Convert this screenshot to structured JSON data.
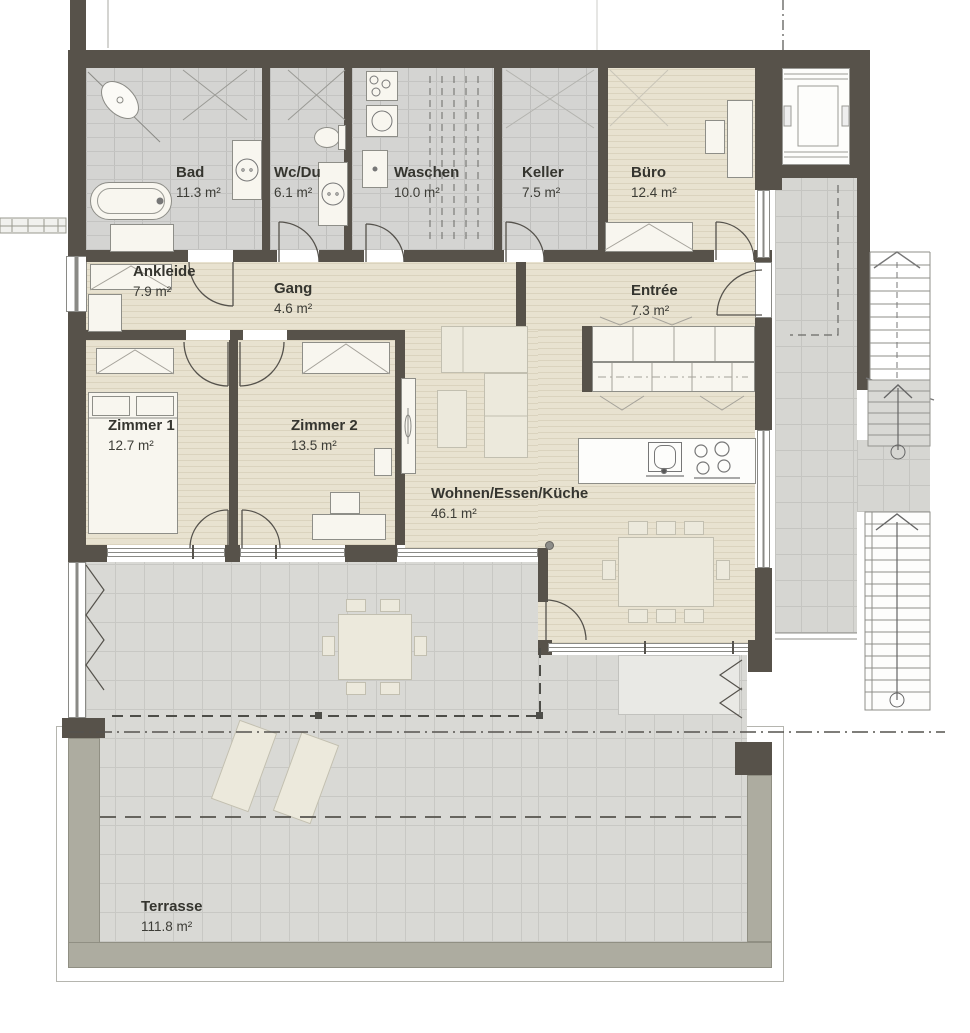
{
  "plan": {
    "rooms": [
      {
        "name": "Bad",
        "area": "11.3 m²"
      },
      {
        "name": "Wc/Du",
        "area": "6.1 m²"
      },
      {
        "name": "Waschen",
        "area": "10.0 m²"
      },
      {
        "name": "Keller",
        "area": "7.5 m²"
      },
      {
        "name": "Büro",
        "area": "12.4 m²"
      },
      {
        "name": "Ankleide",
        "area": "7.9 m²"
      },
      {
        "name": "Gang",
        "area": "4.6 m²"
      },
      {
        "name": "Entrée",
        "area": "7.3 m²"
      },
      {
        "name": "Zimmer 1",
        "area": "12.7 m²"
      },
      {
        "name": "Zimmer 2",
        "area": "13.5 m²"
      },
      {
        "name": "Wohnen/Essen/Küche",
        "area": "46.1 m²"
      },
      {
        "name": "Terrasse",
        "area": "111.8 m²"
      }
    ],
    "colors": {
      "wall": "#57524A",
      "wood_floor": "#E8E2D0",
      "tile_floor": "#D4D4D2",
      "terrace_tile": "#D9D9D5",
      "planter": "#ADACA0",
      "label_text": "#35352F"
    }
  }
}
